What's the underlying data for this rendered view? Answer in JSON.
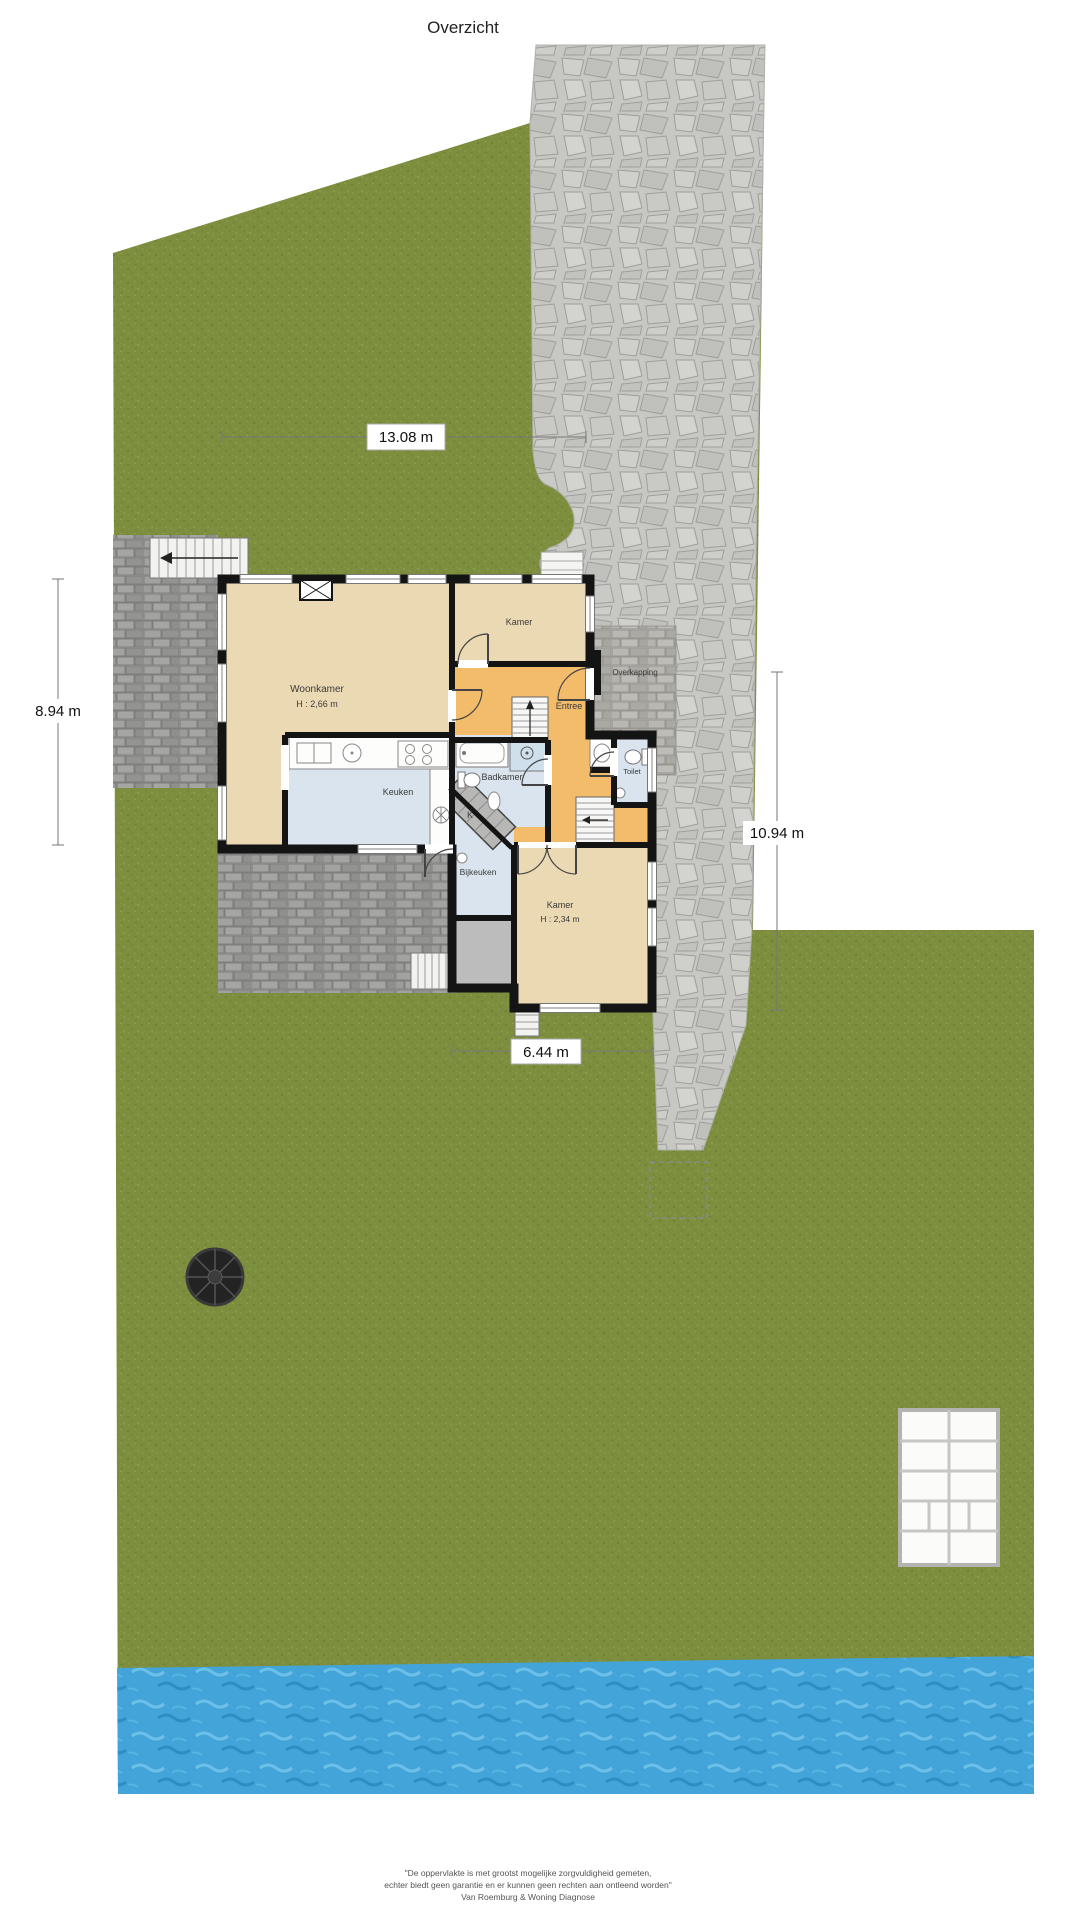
{
  "title": "Overzicht",
  "rooms": {
    "woonkamer": {
      "label": "Woonkamer",
      "height": "H : 2,66 m"
    },
    "kamer_top": {
      "label": "Kamer"
    },
    "entree": {
      "label": "Entree"
    },
    "keuken": {
      "label": "Keuken"
    },
    "badkamer": {
      "label": "Badkamer"
    },
    "toilet": {
      "label": "Toilet"
    },
    "bijkeuken": {
      "label": "Bijkeuken"
    },
    "kast": {
      "label": "K"
    },
    "kamer_onder": {
      "label": "Kamer",
      "height": "H : 2,34 m"
    },
    "overkapping": {
      "label": "Overkapping"
    }
  },
  "dimensions": {
    "top": "13.08 m",
    "left": "8.94 m",
    "right": "10.94 m",
    "bottom": "6.44 m"
  },
  "disclaimer": {
    "line1": "\"De oppervlakte is met grootst mogelijke zorgvuldigheid gemeten,",
    "line2": "echter biedt geen garantie en er kunnen geen rechten aan ontleend worden\"",
    "line3": "Van Roemburg & Woning Diagnose"
  },
  "colors": {
    "grass": "#7d8f3f",
    "stone_path": "#c7c7c3",
    "terrace_brick": "#989896",
    "water": "#42a4d8",
    "room_beige": "#ebd9b3",
    "room_orange": "#f3bc6b",
    "room_blue": "#d9e4ee",
    "wall": "#141414"
  }
}
